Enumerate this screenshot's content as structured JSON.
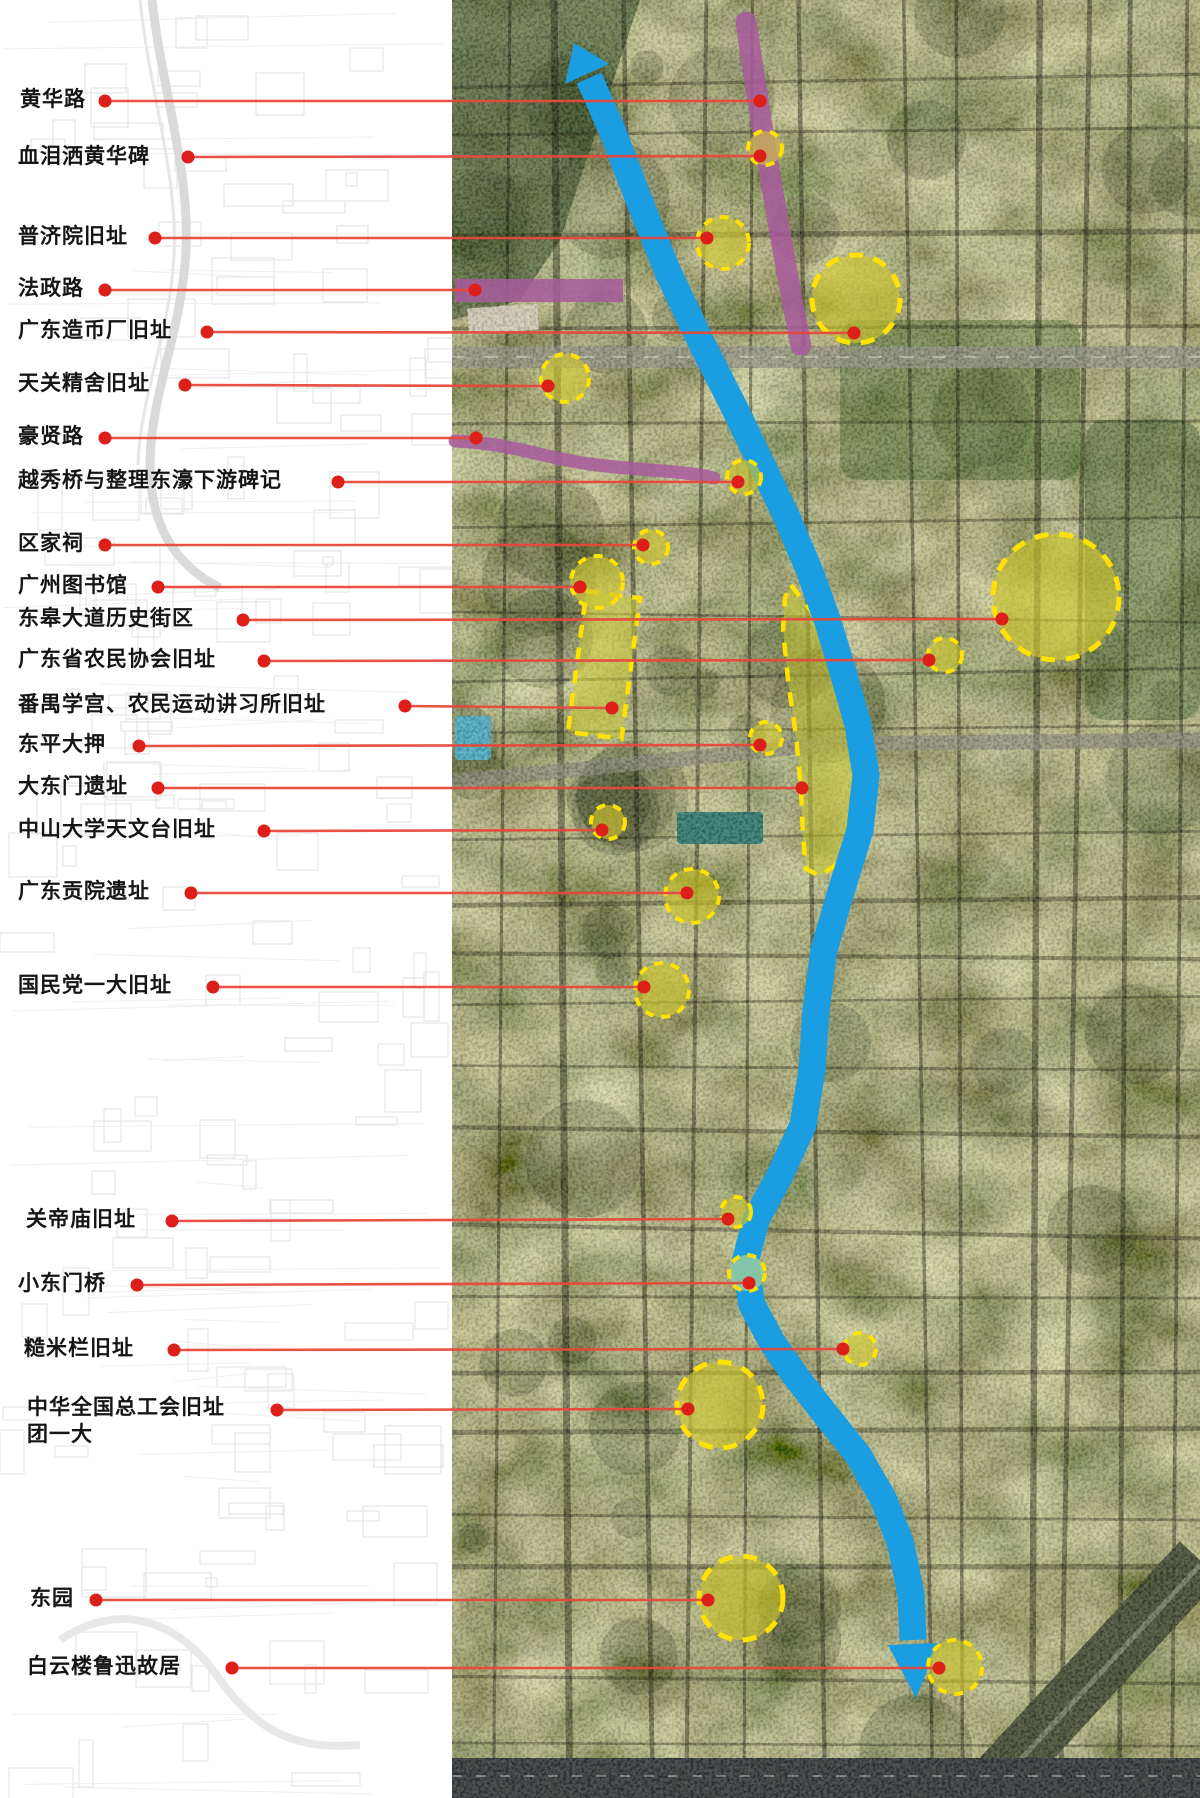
{
  "map": {
    "type": "annotated-satellite-map",
    "description_visible_text_only": true,
    "colors": {
      "leader_line": "#e8483c",
      "dot": "#dd1f1a",
      "river": "#1b9de2",
      "road_highlight": "#a85a9e",
      "site_stroke": "#ffe103",
      "site_fill": "rgba(206,198,43,0.62)",
      "region_fill": "rgba(202,202,48,0.52)"
    },
    "labels": [
      {
        "id": "huanghua-road",
        "text": "黄华路",
        "x": 20,
        "y": 100,
        "dot": [
          105,
          101
        ],
        "end": [
          760,
          101
        ]
      },
      {
        "id": "xuelei-sa-huanghua-stele",
        "text": "血泪洒黄华碑",
        "x": 18,
        "y": 157,
        "dot": [
          188,
          157
        ],
        "end": [
          760,
          156
        ]
      },
      {
        "id": "pujiyuan-site",
        "text": "普济院旧址",
        "x": 18,
        "y": 237,
        "dot": [
          155,
          238
        ],
        "end": [
          707,
          238
        ]
      },
      {
        "id": "fazheng-road",
        "text": "法政路",
        "x": 18,
        "y": 289,
        "dot": [
          105,
          290
        ],
        "end": [
          475,
          290
        ]
      },
      {
        "id": "guangdong-mint-site",
        "text": "广东造币厂旧址",
        "x": 18,
        "y": 331,
        "dot": [
          207,
          332
        ],
        "end": [
          854,
          333
        ]
      },
      {
        "id": "tianguan-jingshe-site",
        "text": "天关精舍旧址",
        "x": 18,
        "y": 384,
        "dot": [
          185,
          385
        ],
        "end": [
          548,
          386
        ]
      },
      {
        "id": "haoxian-road",
        "text": "豪贤路",
        "x": 18,
        "y": 437,
        "dot": [
          105,
          438
        ],
        "end": [
          476,
          438
        ]
      },
      {
        "id": "yuexiu-bridge-stele",
        "text": "越秀桥与整理东濠下游碑记",
        "x": 18,
        "y": 481,
        "dot": [
          338,
          482
        ],
        "end": [
          738,
          482
        ]
      },
      {
        "id": "oujia-ancestral-hall",
        "text": "区家祠",
        "x": 18,
        "y": 544,
        "dot": [
          105,
          545
        ],
        "end": [
          643,
          545
        ]
      },
      {
        "id": "guangzhou-library",
        "text": "广州图书馆",
        "x": 18,
        "y": 586,
        "dot": [
          158,
          587
        ],
        "end": [
          580,
          587
        ]
      },
      {
        "id": "donggao-avenue-historic-district",
        "text": "东皋大道历史街区",
        "x": 18,
        "y": 619,
        "dot": [
          243,
          620
        ],
        "end": [
          1002,
          619
        ]
      },
      {
        "id": "guangdong-peasant-association-site",
        "text": "广东省农民协会旧址",
        "x": 18,
        "y": 660,
        "dot": [
          264,
          661
        ],
        "end": [
          929,
          660
        ]
      },
      {
        "id": "panyu-xuegong-peasant-institute",
        "text": "番禺学宫、农民运动讲习所旧址",
        "x": 18,
        "y": 705,
        "dot": [
          405,
          706
        ],
        "end": [
          612,
          708
        ]
      },
      {
        "id": "dongping-pawnshop",
        "text": "东平大押",
        "x": 18,
        "y": 745,
        "dot": [
          139,
          746
        ],
        "end": [
          760,
          745
        ]
      },
      {
        "id": "dadongmen-ruins",
        "text": "大东门遗址",
        "x": 18,
        "y": 787,
        "dot": [
          158,
          788
        ],
        "end": [
          802,
          788
        ]
      },
      {
        "id": "sysu-observatory-site",
        "text": "中山大学天文台旧址",
        "x": 18,
        "y": 830,
        "dot": [
          264,
          831
        ],
        "end": [
          602,
          830
        ]
      },
      {
        "id": "guangdong-gongyuan-ruins",
        "text": "广东贡院遗址",
        "x": 18,
        "y": 892,
        "dot": [
          191,
          893
        ],
        "end": [
          687,
          893
        ]
      },
      {
        "id": "kmt-first-congress-site",
        "text": "国民党一大旧址",
        "x": 18,
        "y": 986,
        "dot": [
          213,
          987
        ],
        "end": [
          644,
          987
        ]
      },
      {
        "id": "guandi-temple-site",
        "text": "关帝庙旧址",
        "x": 26,
        "y": 1220,
        "dot": [
          172,
          1221
        ],
        "end": [
          728,
          1219
        ]
      },
      {
        "id": "xiaodongmen-bridge",
        "text": "小东门桥",
        "x": 18,
        "y": 1284,
        "dot": [
          137,
          1285
        ],
        "end": [
          749,
          1283
        ]
      },
      {
        "id": "caomilan-site",
        "text": "糙米栏旧址",
        "x": 24,
        "y": 1349,
        "dot": [
          174,
          1350
        ],
        "end": [
          843,
          1349
        ]
      },
      {
        "id": "acftu-site",
        "text": "中华全国总工会旧址",
        "text2": "团一大",
        "x": 27,
        "y": 1408,
        "dot": [
          277,
          1410
        ],
        "end": [
          688,
          1409
        ]
      },
      {
        "id": "dongyuan-garden",
        "text": "东园",
        "x": 30,
        "y": 1599,
        "dot": [
          96,
          1600
        ],
        "end": [
          708,
          1600
        ]
      },
      {
        "id": "baiyunlou-luxun-residence",
        "text": "白云楼鲁迅故居",
        "x": 27,
        "y": 1667,
        "dot": [
          232,
          1668
        ],
        "end": [
          939,
          1668
        ]
      }
    ],
    "sites": [
      {
        "cx": 765,
        "cy": 148,
        "r": 17,
        "fill": "rgba(200,175,85,0.8)"
      },
      {
        "cx": 723,
        "cy": 243,
        "r": 26
      },
      {
        "cx": 856,
        "cy": 299,
        "r": 44
      },
      {
        "cx": 565,
        "cy": 378,
        "r": 24
      },
      {
        "cx": 744,
        "cy": 477,
        "r": 17
      },
      {
        "cx": 651,
        "cy": 547,
        "r": 17
      },
      {
        "cx": 597,
        "cy": 582,
        "r": 26
      },
      {
        "cx": 1056,
        "cy": 597,
        "r": 63
      },
      {
        "cx": 945,
        "cy": 655,
        "r": 17
      },
      {
        "cx": 766,
        "cy": 738,
        "r": 16
      },
      {
        "cx": 608,
        "cy": 822,
        "r": 17
      },
      {
        "cx": 692,
        "cy": 896,
        "r": 27
      },
      {
        "cx": 662,
        "cy": 990,
        "r": 27
      },
      {
        "cx": 736,
        "cy": 1212,
        "r": 15
      },
      {
        "cx": 747,
        "cy": 1273,
        "r": 18,
        "fill": "rgba(150,205,160,0.85)"
      },
      {
        "cx": 860,
        "cy": 1349,
        "r": 16
      },
      {
        "cx": 720,
        "cy": 1405,
        "r": 43
      },
      {
        "cx": 741,
        "cy": 1598,
        "r": 42
      },
      {
        "cx": 955,
        "cy": 1667,
        "r": 27
      }
    ],
    "regions": {
      "xuegong_rect": {
        "x": 577,
        "y": 594,
        "w": 54,
        "h": 142,
        "rotate": 7.5,
        "cx": 604,
        "cy": 665
      },
      "east_bank_strip": {
        "path": "M791,585 L812,612 L836,668 L854,720 L862,770 L857,820 L840,862 L820,876 L806,869 L803,836 L801,790 L796,736 L788,680 L783,630 L785,598 Z"
      }
    },
    "roads": [
      {
        "id": "huanghua-road-highlight",
        "path": "M746,22 C762,130 780,240 801,345",
        "width": 21
      },
      {
        "id": "fazheng-road-highlight",
        "rect": [
          455,
          279,
          168,
          23
        ]
      },
      {
        "id": "haoxian-road-highlight",
        "path": "M455,441 C510,443 545,458 590,464 C640,471 682,470 714,478",
        "width": 13
      }
    ],
    "river": {
      "name": "route-arrow",
      "width": 27,
      "points": [
        [
          589,
          78
        ],
        [
          612,
          130
        ],
        [
          641,
          205
        ],
        [
          668,
          272
        ],
        [
          700,
          340
        ],
        [
          733,
          405
        ],
        [
          762,
          465
        ],
        [
          788,
          520
        ],
        [
          810,
          572
        ],
        [
          828,
          622
        ],
        [
          843,
          672
        ],
        [
          858,
          725
        ],
        [
          866,
          775
        ],
        [
          860,
          830
        ],
        [
          840,
          895
        ],
        [
          824,
          950
        ],
        [
          816,
          1010
        ],
        [
          812,
          1070
        ],
        [
          803,
          1125
        ],
        [
          780,
          1175
        ],
        [
          756,
          1220
        ],
        [
          745,
          1262
        ],
        [
          752,
          1305
        ],
        [
          772,
          1342
        ],
        [
          797,
          1378
        ],
        [
          826,
          1415
        ],
        [
          858,
          1455
        ],
        [
          884,
          1500
        ],
        [
          901,
          1545
        ],
        [
          911,
          1595
        ],
        [
          913,
          1640
        ]
      ],
      "arrow_head_top": "574,43 609,64 565,84",
      "arrow_head_bottom": "916,1698 938,1643 888,1645"
    },
    "satellite_area": {
      "x": 452,
      "y": 0,
      "w": 748,
      "h": 1798
    }
  }
}
